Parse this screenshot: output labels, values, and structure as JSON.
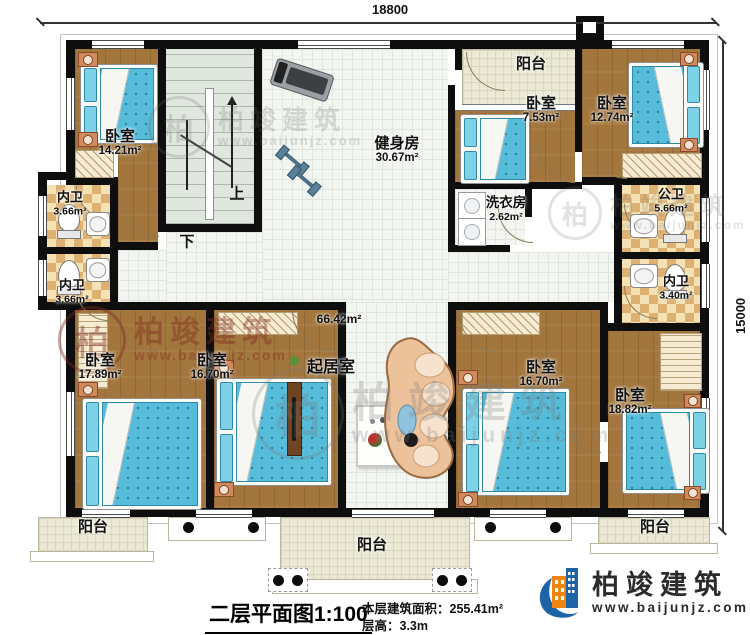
{
  "plan": {
    "type": "residential-floor-plan",
    "scale_note": "1:100"
  },
  "dimensions": {
    "width": "18800",
    "height": "15000"
  },
  "stairs": {
    "up": "上",
    "down": "下"
  },
  "rooms": [
    {
      "id": "bedroom-top-left",
      "name": "卧室",
      "area": "14.21m²"
    },
    {
      "id": "gym",
      "name": "健身房",
      "area": "30.67m²"
    },
    {
      "id": "balcony-top",
      "name": "阳台",
      "area": ""
    },
    {
      "id": "bedroom-top-mid",
      "name": "卧室",
      "area": "7.53m²"
    },
    {
      "id": "bedroom-top-right",
      "name": "卧室",
      "area": "12.74m²"
    },
    {
      "id": "bath-left-upper",
      "name": "内卫",
      "area": "3.66m²"
    },
    {
      "id": "bath-left-lower",
      "name": "内卫",
      "area": "3.66m²"
    },
    {
      "id": "laundry",
      "name": "洗衣房",
      "area": "2.62m²"
    },
    {
      "id": "bath-public",
      "name": "公卫",
      "area": "5.66m²"
    },
    {
      "id": "bath-right",
      "name": "内卫",
      "area": "3.40m²"
    },
    {
      "id": "bedroom-bottom-left",
      "name": "卧室",
      "area": "17.89m²"
    },
    {
      "id": "bedroom-bottom-midleft",
      "name": "卧室",
      "area": "16.70m²"
    },
    {
      "id": "living-room",
      "name": "起居室",
      "area": "66.42m²"
    },
    {
      "id": "bedroom-bottom-midright",
      "name": "卧室",
      "area": "16.70m²"
    },
    {
      "id": "bedroom-bottom-right",
      "name": "卧室",
      "area": "18.82m²"
    },
    {
      "id": "balcony-bottom-left",
      "name": "阳台",
      "area": ""
    },
    {
      "id": "balcony-bottom-center",
      "name": "阳台",
      "area": ""
    },
    {
      "id": "balcony-bottom-right",
      "name": "阳台",
      "area": ""
    }
  ],
  "title_block": {
    "title": "二层平面图1:100",
    "building_area": "本层建筑面积：255.41m²",
    "floor_height": "层高：3.3m"
  },
  "logo": {
    "brand": "柏竣建筑",
    "site": "www.baijunjz.com"
  },
  "watermark": {
    "brand": "柏竣建筑",
    "site": "www.baijunjz.com"
  },
  "palette": {
    "wall": "#0e0e0e",
    "wood_floor": "#a3763e",
    "tile_floor": "#f3f5f0",
    "bath_checker": "#ddb172",
    "balcony_floor": "#ebe9d6",
    "bed_mattress": "#57bcd9",
    "sofa": "#ecc29b",
    "logo_blue": "#1c63a8",
    "logo_orange": "#f0860f"
  }
}
